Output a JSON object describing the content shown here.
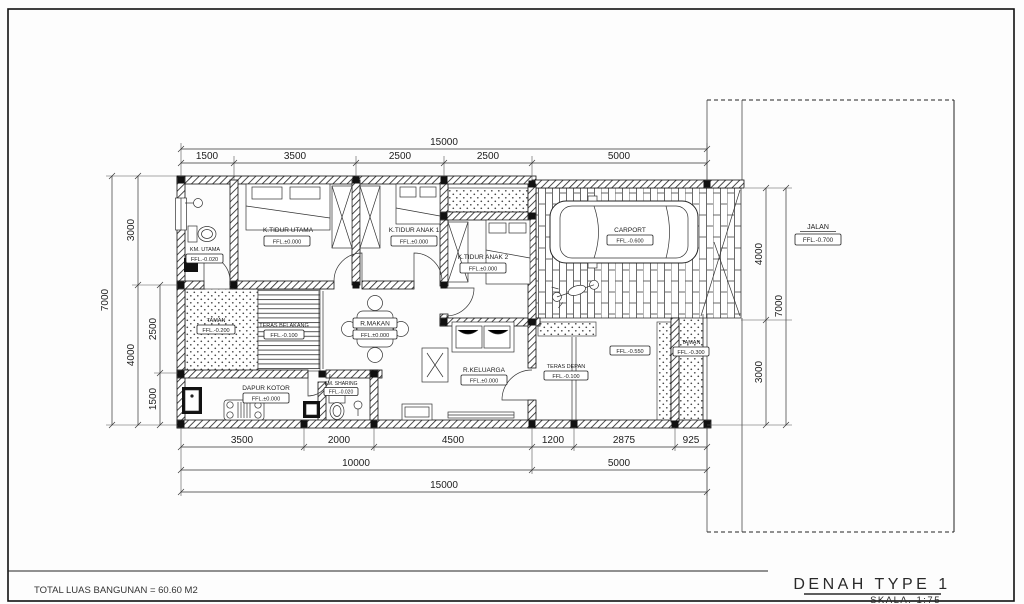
{
  "page": {
    "footer_note": "TOTAL LUAS BANGUNAN = 60.60 M2",
    "title": "DENAH TYPE 1",
    "scale": "SKALA. 1:75"
  },
  "rooms": {
    "km_utama": {
      "label": "KM. UTAMA",
      "ffl": "FFL.-0.020"
    },
    "k_tidur_utama": {
      "label": "K.TIDUR UTAMA",
      "ffl": "FFL.±0.000"
    },
    "k_tidur_anak1": {
      "label": "K.TIDUR ANAK 1",
      "ffl": "FFL.±0.000"
    },
    "k_tidur_anak2": {
      "label": "K.TIDUR ANAK 2",
      "ffl": "FFL.±0.000"
    },
    "carport": {
      "label": "CARPORT",
      "ffl": "FFL.-0.600"
    },
    "taman_belakang": {
      "label": "TAMAN",
      "ffl": "FFL.-0.200"
    },
    "teras_belakang": {
      "label": "TERAS BELAKANG",
      "ffl": "FFL.-0.100"
    },
    "r_makan": {
      "label": "R.MAKAN",
      "ffl": "FFL.±0.000"
    },
    "dapur_kotor": {
      "label": "DAPUR KOTOR",
      "ffl": "FFL.±0.000"
    },
    "km_sharing": {
      "label": "KM. SHARING",
      "ffl": "FFL.-0.020"
    },
    "r_keluarga": {
      "label": "R.KELUARGA",
      "ffl": "FFL.±0.000"
    },
    "teras_depan": {
      "label": "TERAS DEPAN",
      "ffl": "FFL.-0.100"
    },
    "halaman": {
      "ffl": "FFL.-0.550"
    },
    "taman_depan": {
      "label": "TAMAN",
      "ffl": "FFL.-0.300"
    },
    "jalan": {
      "label": "JALAN",
      "ffl": "FFL.-0.700"
    }
  },
  "dims": {
    "top_total": "15000",
    "top": [
      "1500",
      "3500",
      "2500",
      "2500",
      "5000"
    ],
    "bottom1": [
      "3500",
      "2000",
      "4500",
      "1200",
      "2875",
      "925"
    ],
    "bottom2": [
      "10000",
      "5000"
    ],
    "bottom_total": "15000",
    "left": {
      "outer": "7000",
      "mid": [
        "3000",
        "4000"
      ],
      "inner": [
        "2500",
        "1500"
      ]
    },
    "right": {
      "inner": [
        "4000",
        "3000"
      ],
      "outer": "7000"
    }
  }
}
